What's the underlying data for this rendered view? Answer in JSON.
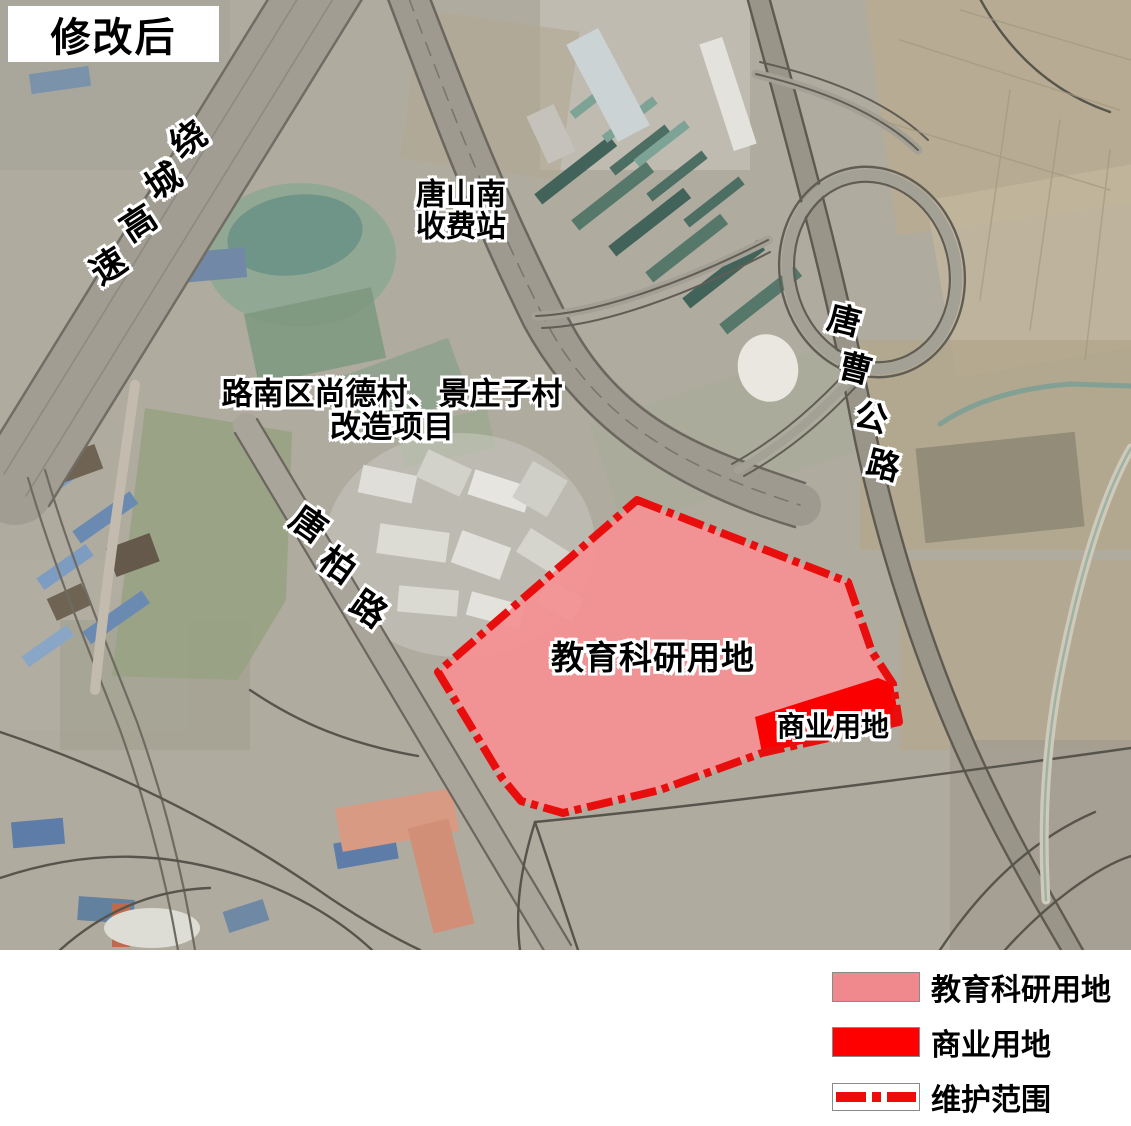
{
  "title_badge": {
    "label": "修改后"
  },
  "map": {
    "labels": {
      "toll_station_line1": "唐山南",
      "toll_station_line2": "收费站",
      "project_line1": "路南区尚德村、景庄子村",
      "project_line2": "改造项目",
      "education_area": "教育科研用地",
      "commercial_area": "商业用地"
    },
    "road_labels": [
      {
        "id": "ring-expressway",
        "text": "绕城高速",
        "char_rotation_deg": -33,
        "font_size": 35,
        "char_positions": [
          [
            187,
            137
          ],
          [
            162,
            179
          ],
          [
            137,
            221
          ],
          [
            107,
            264
          ]
        ]
      },
      {
        "id": "tangbai-road",
        "text": "唐柏路",
        "char_rotation_deg": 35,
        "font_size": 35,
        "char_positions": [
          [
            310,
            522
          ],
          [
            339,
            563
          ],
          [
            370,
            607
          ]
        ]
      },
      {
        "id": "tangcao-highway",
        "text": "唐曹公路",
        "char_rotation_deg": 14,
        "font_size": 33,
        "char_positions": [
          [
            845,
            318
          ],
          [
            856,
            366
          ],
          [
            872,
            415
          ],
          [
            884,
            463
          ]
        ]
      }
    ],
    "zones": [
      {
        "id": "education",
        "label": "教育科研用地",
        "fill": "#F59193"
      },
      {
        "id": "commercial",
        "label": "商业用地",
        "fill": "#FA0000"
      }
    ],
    "boundary_color": "#E90E0E"
  },
  "legend": {
    "items": [
      {
        "label": "教育科研用地",
        "swatch": "pink-fill",
        "color": "#F0898D"
      },
      {
        "label": "商业用地",
        "swatch": "red-fill",
        "color": "#FE0000"
      },
      {
        "label": "维护范围",
        "swatch": "dash-dot-line",
        "color": "#ED0C0C"
      }
    ]
  }
}
